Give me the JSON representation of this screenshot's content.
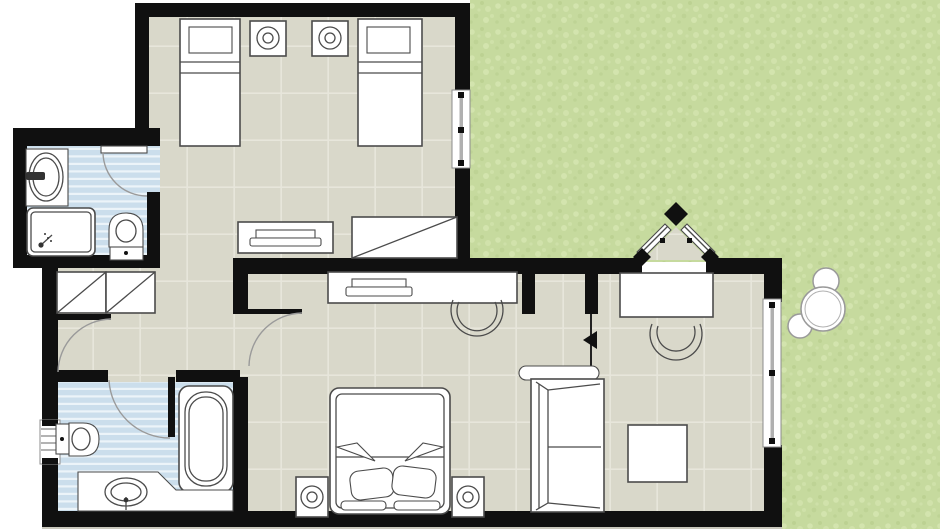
{
  "meta": {
    "type": "architectural-floor-plan",
    "canvas_width": 940,
    "canvas_height": 529,
    "visible_text": "none"
  },
  "colors": {
    "paper": "#ffffff",
    "wall": "#101010",
    "floor": "#d9d8ca",
    "tile": "#e7e6db",
    "bathFloor": "#cbdeec",
    "bathStripe": "#ecf4f9",
    "grass": "#c6da9e",
    "grassLight": "#d6e6b1",
    "grassDark": "#b6cc8b",
    "furnitureFill": "#ffffff",
    "furnitureStroke": "#4b4b4b",
    "arc": "#9a9a9a",
    "rod": "#b0b0b0",
    "winBorder": "#8c8c8c",
    "shadow": "#c9c8bd"
  },
  "rooms": {
    "twinBedroom": {
      "name": "twin bedroom",
      "items": [
        "single bed",
        "single bed",
        "nightstand with lamp",
        "nightstand with lamp",
        "tv console",
        "luggage bench",
        "window"
      ]
    },
    "topBathroom": {
      "name": "en-suite bathroom",
      "items": [
        "washbasin",
        "shower tray",
        "toilet",
        "swing door"
      ]
    },
    "hallway": {
      "name": "hallway",
      "items": [
        "double wardrobe",
        "swing door",
        "swing door"
      ]
    },
    "mainBathroom": {
      "name": "main bathroom",
      "items": [
        "bathtub",
        "toilet",
        "vanity washbasin",
        "louvered vent",
        "swing door"
      ]
    },
    "livingBedroom": {
      "name": "living room / master bedroom",
      "items": [
        "double bed",
        "nightstand with lamp",
        "nightstand with lamp",
        "sofa",
        "coffee table",
        "desk with chair and tray",
        "dining table with chair",
        "corner entrance double door",
        "window",
        "partition marker"
      ]
    },
    "garden": {
      "name": "garden",
      "items": [
        "tree"
      ]
    }
  }
}
